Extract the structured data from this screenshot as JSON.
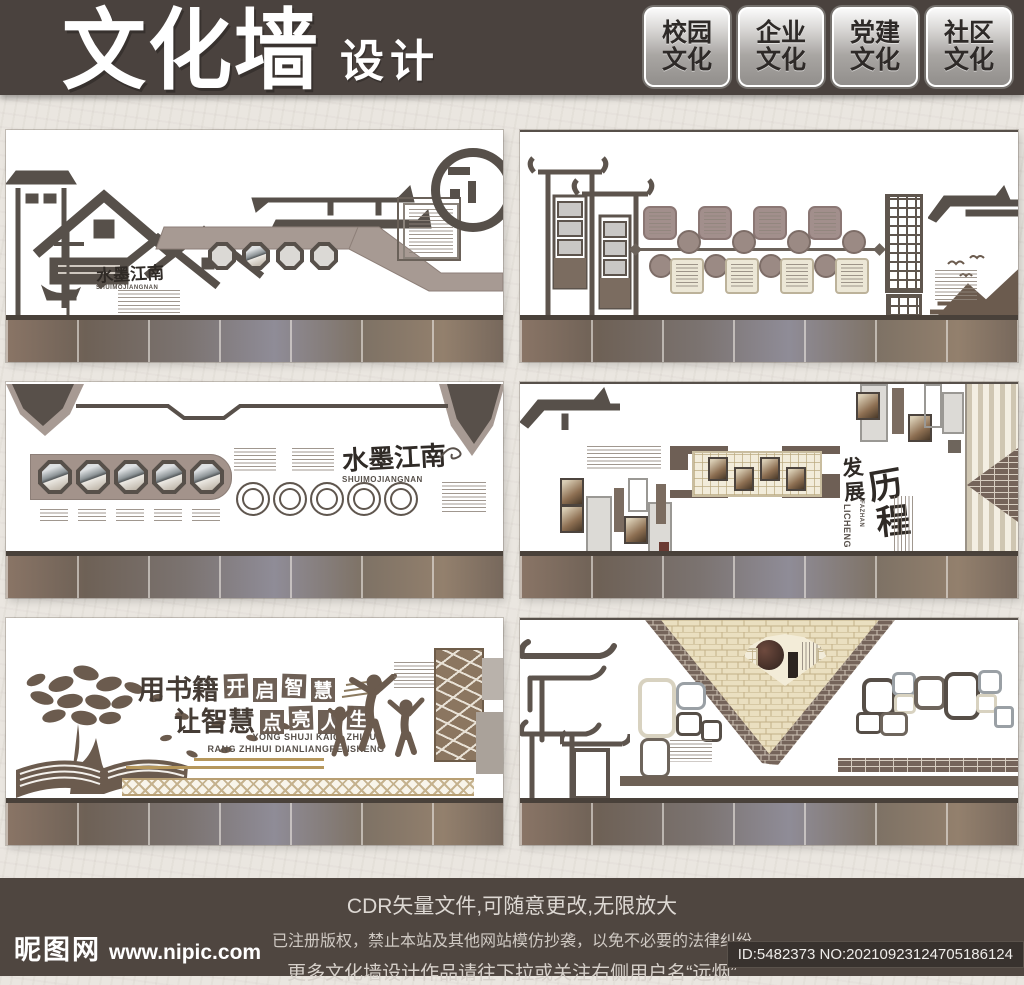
{
  "palette": {
    "header_bg": "#4a423e",
    "footer_bg": "#4f4640",
    "paper": "#eae6e0",
    "silhouette": "#57504a",
    "taupe": "#a5968e",
    "gold": "#b6975c",
    "cream_brick": "#eadfc0",
    "mauve": "#a28f8c"
  },
  "header": {
    "title": "文化墙",
    "subtitle": "设计",
    "badges": [
      {
        "line1": "校园",
        "line2": "文化"
      },
      {
        "line1": "企业",
        "line2": "文化"
      },
      {
        "line1": "党建",
        "line2": "文化"
      },
      {
        "line1": "社区",
        "line2": "文化"
      }
    ]
  },
  "panels": {
    "p1": {
      "title": "水墨江南",
      "pinyin": "SHUIMOJIANGNAN"
    },
    "p3": {
      "title": "水墨江南",
      "pinyin": "SHUIMOJIANGNAN"
    },
    "p4": {
      "chars": [
        "发",
        "展",
        "历",
        "程"
      ],
      "pinyin_a": "FAZHAN",
      "pinyin_b": "LICHENG"
    },
    "p5": {
      "prefix1": "用书籍",
      "boxes1": [
        "开",
        "启",
        "智",
        "慧"
      ],
      "prefix2": "让智慧",
      "boxes2": [
        "点",
        "亮",
        "人",
        "生"
      ],
      "pinyin1": "YONG SHUJI KAIQI ZHIHUI",
      "pinyin2": "RANG ZHIHUI DIANLIANGRENSHENG"
    }
  },
  "footer": {
    "line1": "CDR矢量文件,可随意更改,无限放大",
    "line2": "已注册版权，禁止本站及其他网站模仿抄袭，以免不必要的法律纠纷",
    "line3": "更多文化墙设计作品请往下拉或关注右侧用户名“远烟”",
    "site_name": "昵图网",
    "site_url": "www.nipic.com",
    "image_id": "ID:5482373 NO:20210923124705186124"
  }
}
